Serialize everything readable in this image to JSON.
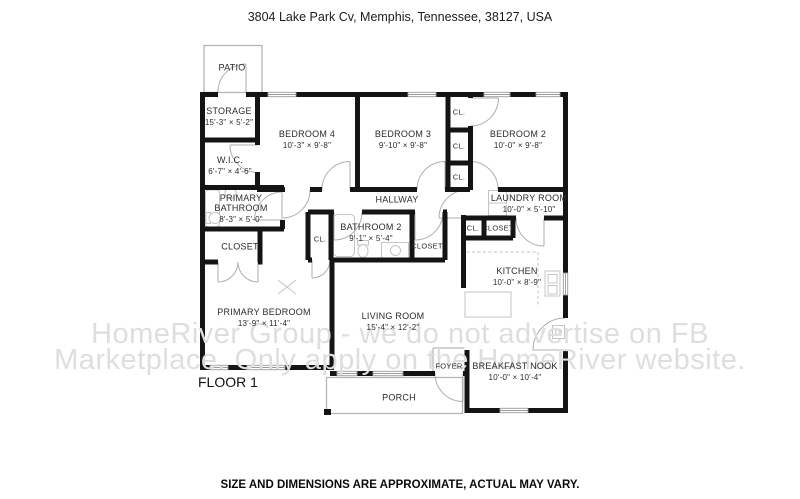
{
  "page": {
    "title": "3804 Lake Park Cv, Memphis, Tennessee, 38127, USA",
    "floor_label": "FLOOR 1",
    "disclaimer": "SIZE AND DIMENSIONS ARE APPROXIMATE, ACTUAL MAY VARY.",
    "watermark_line1": "HomeRiver Group - we do not advertise on FB",
    "watermark_line2": "Marketplace. Only apply on the HomeRiver website."
  },
  "rooms": {
    "patio": {
      "name": "PATIO"
    },
    "storage": {
      "name": "STORAGE",
      "dims": "15'-3\" × 5'-2\""
    },
    "bedroom4": {
      "name": "BEDROOM 4",
      "dims": "10'-3\" × 9'-8\""
    },
    "bedroom3": {
      "name": "BEDROOM 3",
      "dims": "9'-10\" × 9'-8\""
    },
    "bedroom2": {
      "name": "BEDROOM 2",
      "dims": "10'-0\" × 9'-8\""
    },
    "wic": {
      "name": "W.I.C.",
      "dims": "6'-7\" × 4'-6\""
    },
    "primary_bathroom": {
      "name": "PRIMARY BATHROOM",
      "dims": "8'-3\" × 5'-0\""
    },
    "closet_primary": {
      "name": "CLOSET"
    },
    "hallway": {
      "name": "HALLWAY"
    },
    "bathroom2": {
      "name": "BATHROOM 2",
      "dims": "9'-1\" × 5'-4\""
    },
    "cl_hall": {
      "name": "CL."
    },
    "closet_hall": {
      "name": "CLOSET"
    },
    "laundry": {
      "name": "LAUNDRY ROOM",
      "dims": "10'-0\" × 5'-10\""
    },
    "cl_laundry": {
      "name": "CL."
    },
    "closet_laundry": {
      "name": "CLOSET"
    },
    "kitchen": {
      "name": "KITCHEN",
      "dims": "10'-0\" × 8'-9\""
    },
    "primary_bedroom": {
      "name": "PRIMARY BEDROOM",
      "dims": "13'-9\" × 11'-4\""
    },
    "living_room": {
      "name": "LIVING ROOM",
      "dims": "15'-4\" × 12'-2\""
    },
    "foyer": {
      "name": "FOYER"
    },
    "breakfast_nook": {
      "name": "BREAKFAST NOOK",
      "dims": "10'-0\" × 10'-4\""
    },
    "porch": {
      "name": "PORCH"
    },
    "cl_bedrooms_top": {
      "name": "CL."
    },
    "cl_bedrooms_mid": {
      "name": "CL."
    },
    "cl_bedrooms_bottom": {
      "name": "CL."
    }
  }
}
